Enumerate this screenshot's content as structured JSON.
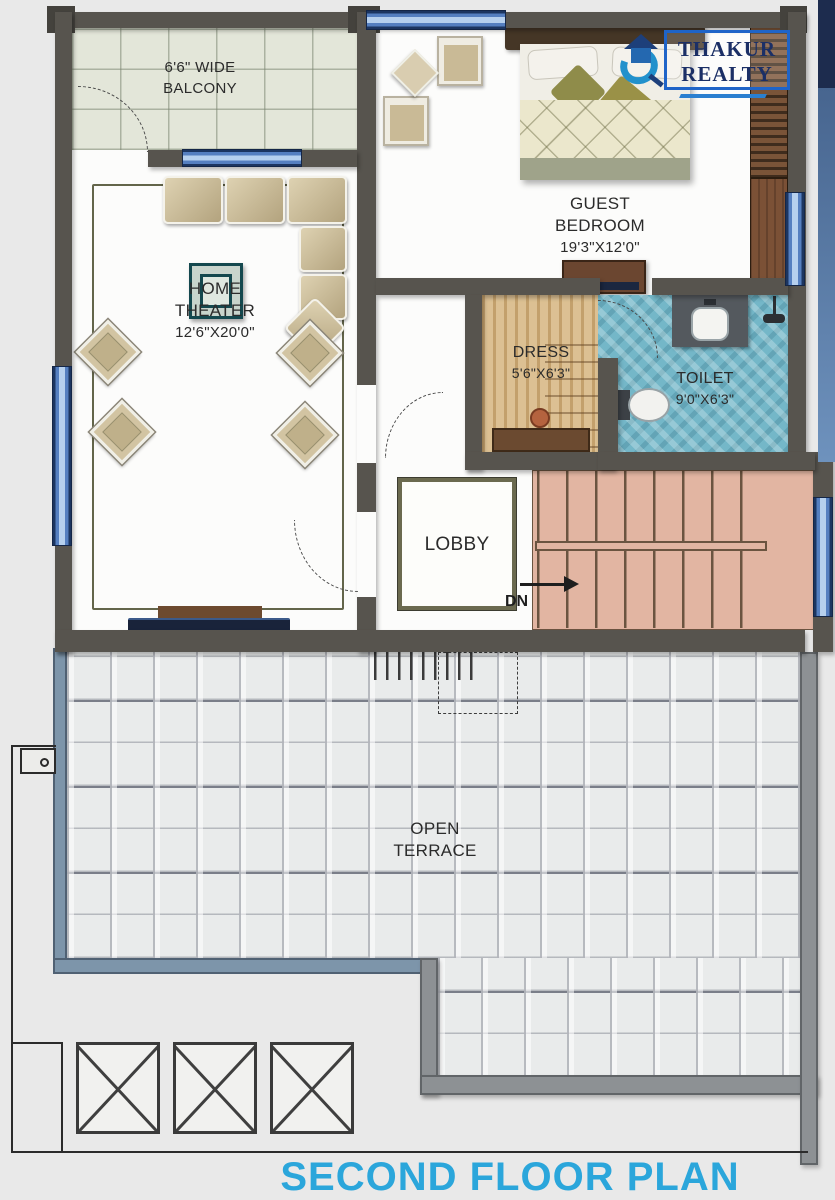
{
  "title": "SECOND FLOOR PLAN",
  "logo": {
    "name_top": "THAKUR",
    "name_bottom": "REALTY"
  },
  "rooms": {
    "balcony": {
      "line1": "6'6\" WIDE",
      "line2": "BALCONY"
    },
    "guest_bedroom": {
      "line1": "GUEST",
      "line2": "BEDROOM",
      "dims": "19'3\"X12'0\""
    },
    "home_theater": {
      "line1": "HOME",
      "line2": "THEATER",
      "dims": "12'6\"X20'0\""
    },
    "dress": {
      "line1": "DRESS",
      "dims": "5'6\"X6'3\""
    },
    "toilet": {
      "line1": "TOILET",
      "dims": "9'0\"X6'3\""
    },
    "lobby": {
      "line1": "LOBBY"
    },
    "open_terrace": {
      "line1": "OPEN",
      "line2": "TERRACE"
    },
    "stairs": {
      "down_label": "DN"
    }
  },
  "colors": {
    "title_blue": "#2ba6db",
    "logo_navy": "#1b2f66",
    "wall_dark": "#57544e",
    "parapet_blue": "#7d95aa",
    "stairs_salmon": "#e2b5a2",
    "toilet_blue": "#74b7c8",
    "dress_tan": "#d6b584",
    "window_blue": "#557fc0"
  }
}
